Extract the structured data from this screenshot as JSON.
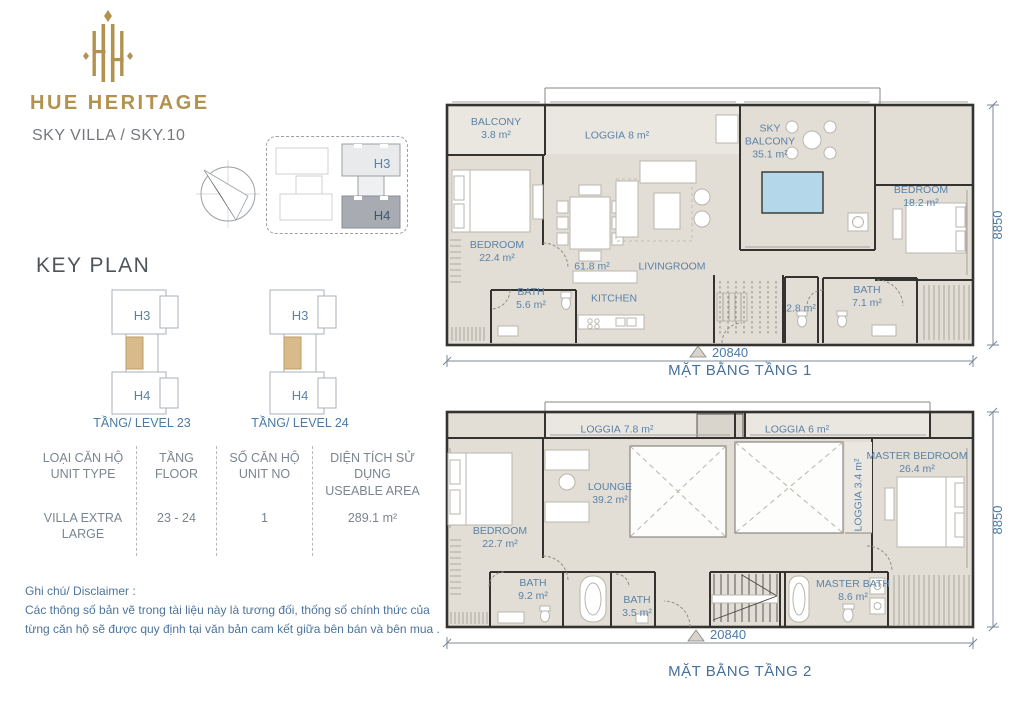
{
  "brand": {
    "name": "HUE HERITAGE",
    "subtitle": "SKY VILLA / SKY.10",
    "gold_color": "#b3914f"
  },
  "inset": {
    "h3": "H3",
    "h4": "H4"
  },
  "key_plan": {
    "heading": "KEY PLAN",
    "highlight_color": "#d9ba8a",
    "levels": [
      {
        "h3": "H3",
        "h4": "H4",
        "caption": "TẦNG/ LEVEL 23"
      },
      {
        "h3": "H3",
        "h4": "H4",
        "caption": "TẦNG/ LEVEL 24"
      }
    ]
  },
  "info_table": {
    "columns": [
      {
        "header_vi": "LOẠI CĂN HỘ",
        "header_en": "UNIT TYPE",
        "value": "VILLA EXTRA LARGE"
      },
      {
        "header_vi": "TẦNG",
        "header_en": "FLOOR",
        "value": "23 - 24"
      },
      {
        "header_vi": "SỐ CĂN HỘ",
        "header_en": "UNIT NO",
        "value": "1"
      },
      {
        "header_vi": "DIỆN TÍCH SỬ DỤNG",
        "header_en": "USEABLE AREA",
        "value": "289.1 m²"
      }
    ]
  },
  "disclaimer": {
    "title": "Ghi chú/ Disclaimer :",
    "lines": [
      "Các thông số bản vẽ trong tài liệu này là tương đối, thống số  chính thức của",
      "từng căn hộ sẽ được quy định tại văn bản cam kết giữa bên bán và bên mua ."
    ]
  },
  "floors": [
    {
      "caption": "MẶT BẰNG TẦNG 1",
      "dim_width": "20840",
      "dim_height": "8850",
      "rooms": [
        {
          "name": "BALCONY",
          "area": "3.8 m²"
        },
        {
          "name": "LOGGIA",
          "area": "8 m²"
        },
        {
          "name": "SKY BALCONY",
          "area": "35.1 m²"
        },
        {
          "name": "BEDROOM",
          "area": "18.2 m²"
        },
        {
          "name": "BEDROOM",
          "area": "22.4 m²"
        },
        {
          "name": "",
          "area": "61.8 m²"
        },
        {
          "name": "LIVINGROOM",
          "area": ""
        },
        {
          "name": "BATH",
          "area": "5.6 m²"
        },
        {
          "name": "KITCHEN",
          "area": ""
        },
        {
          "name": "",
          "area": "2.8 m²"
        },
        {
          "name": "BATH",
          "area": "7.1 m²"
        }
      ]
    },
    {
      "caption": "MẶT BẰNG TẦNG 2",
      "dim_width": "20840",
      "dim_height": "8850",
      "rooms": [
        {
          "name": "LOGGIA",
          "area": "7.8 m²"
        },
        {
          "name": "LOGGIA",
          "area": "6 m²"
        },
        {
          "name": "LOUNGE",
          "area": "39.2 m²"
        },
        {
          "name": "BEDROOM",
          "area": "22.7 m²"
        },
        {
          "name": "LOGGIA",
          "area": "3.4 m²"
        },
        {
          "name": "MASTER BEDROOM",
          "area": "26.4 m²"
        },
        {
          "name": "BATH",
          "area": "9.2 m²"
        },
        {
          "name": "BATH",
          "area": "3.5 m²"
        },
        {
          "name": "MASTER BATH",
          "area": "8.6 m²"
        }
      ]
    }
  ]
}
